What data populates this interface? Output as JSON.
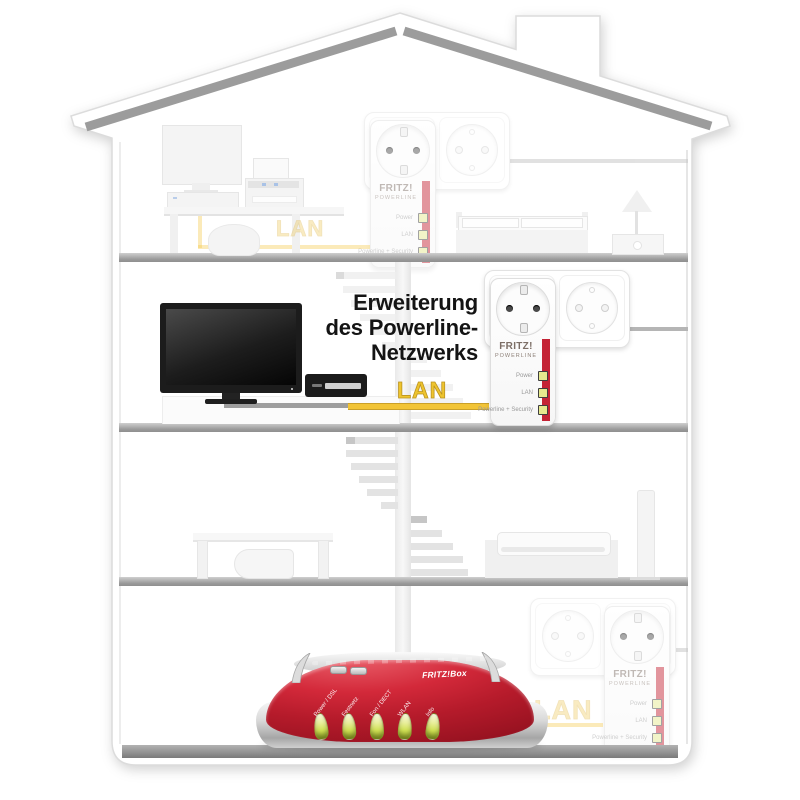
{
  "headline": {
    "line1": "Erweiterung",
    "line2": "des Powerline-",
    "line3": "Netzwerks"
  },
  "labels": {
    "lan_mid": "LAN",
    "lan_top": "LAN",
    "lan_bottom": "LAN"
  },
  "powerline_adapter": {
    "brand_line1": "FRITZ!",
    "brand_line2": "Powerline",
    "leds": [
      "Power",
      "LAN",
      "Powerline + Security"
    ]
  },
  "router": {
    "brand": "FRITZ!Box",
    "leds": [
      "Power / DSL",
      "Festnetz",
      "Fon / DECT",
      "WLAN",
      "Info"
    ]
  },
  "colors": {
    "lan_yellow": "#f2c436",
    "fritz_red": "#c42335",
    "router_red": "#c2202f",
    "led_yellow_green": "#dce36e",
    "floor_gray": "#a3a3a3"
  }
}
